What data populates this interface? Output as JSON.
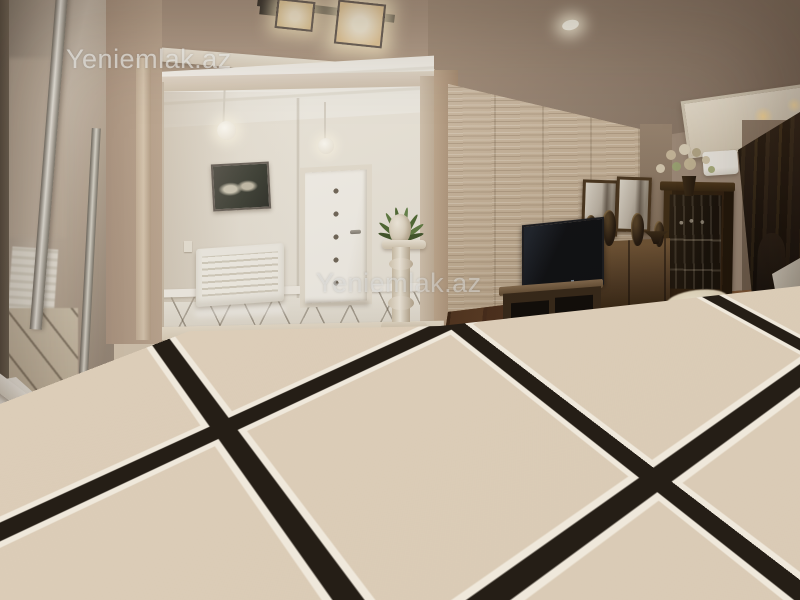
{
  "scene": {
    "description": "Real-estate listing photo of an apartment interior: a glossy marble-tiled entry hall with black inlay grid opens to a living room with dark parquet floor, travertine accent wall, TV unit, mirrored sideboard, glass display cabinet, curtains and a dining corner",
    "watermark": {
      "text": "Yeniemlak.az",
      "instances": [
        {
          "position": "top-left",
          "text": "Yeniemlak.az"
        },
        {
          "position": "center",
          "text": "Yeniemlak.az"
        },
        {
          "position": "bottom-right",
          "text": "Yeniemlak.az"
        }
      ]
    },
    "palette": {
      "wall_beige": "#b29c89",
      "ceiling_taupe": "#8d7a6b",
      "vestibule_white": "#ece7dc",
      "marble_tile": "#d7c8b3",
      "tile_inlay_black": "#251e16",
      "wood_floor": "#6b4427",
      "stone_wall": "#c6b39a",
      "furniture_wood": "#3a2817",
      "curtain_brown": "#221711",
      "watermark_gray": "rgba(240,240,238,0.62)"
    },
    "objects": [
      "mirrored wardrobe",
      "white radiator cover",
      "archway",
      "pendant globe lamps",
      "framed picture",
      "white interior door with inlay dots",
      "decorative pedestal with plant",
      "travertine accent wall",
      "flat-screen TV",
      "TV stand",
      "sideboard with two mirrors",
      "decorative urns",
      "glass display cabinet",
      "flower bouquet",
      "air conditioner",
      "patterned curtains",
      "dining chair",
      "white tablecloth",
      "sheepskin rug",
      "oriental rug corner",
      "fringed area rug",
      "recessed spotlight",
      "square glass ceiling fixture"
    ]
  }
}
